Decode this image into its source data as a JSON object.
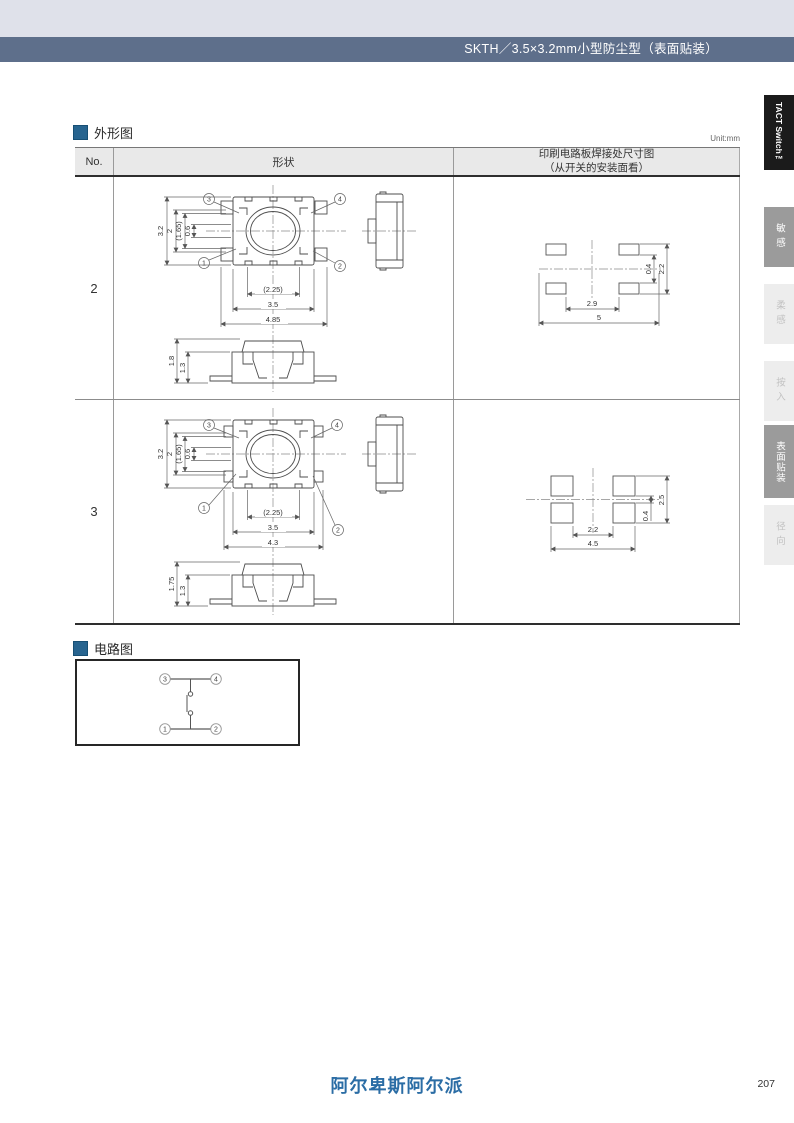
{
  "page": {
    "header_title": "SKTH／3.5×3.2mm小型防尘型（表面贴装）",
    "footer_logo": "阿尔卑斯阿尔派",
    "page_number": "207"
  },
  "side_tabs": {
    "product": "TACT Switch™",
    "categories": [
      {
        "label": "敏感",
        "active": true
      },
      {
        "label": "柔感",
        "active": false
      },
      {
        "label": "按入",
        "active": false
      },
      {
        "label": "表面贴装",
        "active": true
      },
      {
        "label": "径向",
        "active": false
      }
    ]
  },
  "outline": {
    "title": "外形图",
    "unit": "Unit:mm",
    "columns": {
      "no": "No.",
      "shape": "形状",
      "pcb_line1": "印刷电路板焊接处尺寸图",
      "pcb_line2": "（从开关的安装面看）"
    },
    "rows": [
      {
        "no": "2",
        "top_view": {
          "dims_vertical": [
            "3.2",
            "2",
            "(1.65)",
            "0.6"
          ],
          "dims_horizontal": [
            "(2.25)",
            "3.5",
            "4.85"
          ],
          "pins": {
            "tl": "3",
            "tr": "4",
            "bl": "1",
            "br": "2"
          }
        },
        "front_view": {
          "dims": [
            "1.8",
            "1.3"
          ]
        },
        "pad_layout": {
          "dims_vertical": [
            "0.4",
            "2.2"
          ],
          "dims_horizontal": [
            "2.9",
            "5"
          ]
        }
      },
      {
        "no": "3",
        "top_view": {
          "dims_vertical": [
            "3.2",
            "2",
            "(1.65)",
            "0.6"
          ],
          "dims_horizontal": [
            "(2.25)",
            "3.5",
            "4.3"
          ],
          "pins": {
            "tl": "3",
            "tr": "4",
            "bl": "1",
            "br": "2"
          }
        },
        "front_view": {
          "dims": [
            "1.75",
            "1.3"
          ]
        },
        "pad_layout": {
          "dims_vertical": [
            "2.5",
            "0.4"
          ],
          "dims_horizontal": [
            "2.2",
            "4.5"
          ]
        }
      }
    ]
  },
  "circuit": {
    "title": "电路图",
    "pins": {
      "p3": "3",
      "p4": "4",
      "p1": "1",
      "p2": "2"
    }
  }
}
